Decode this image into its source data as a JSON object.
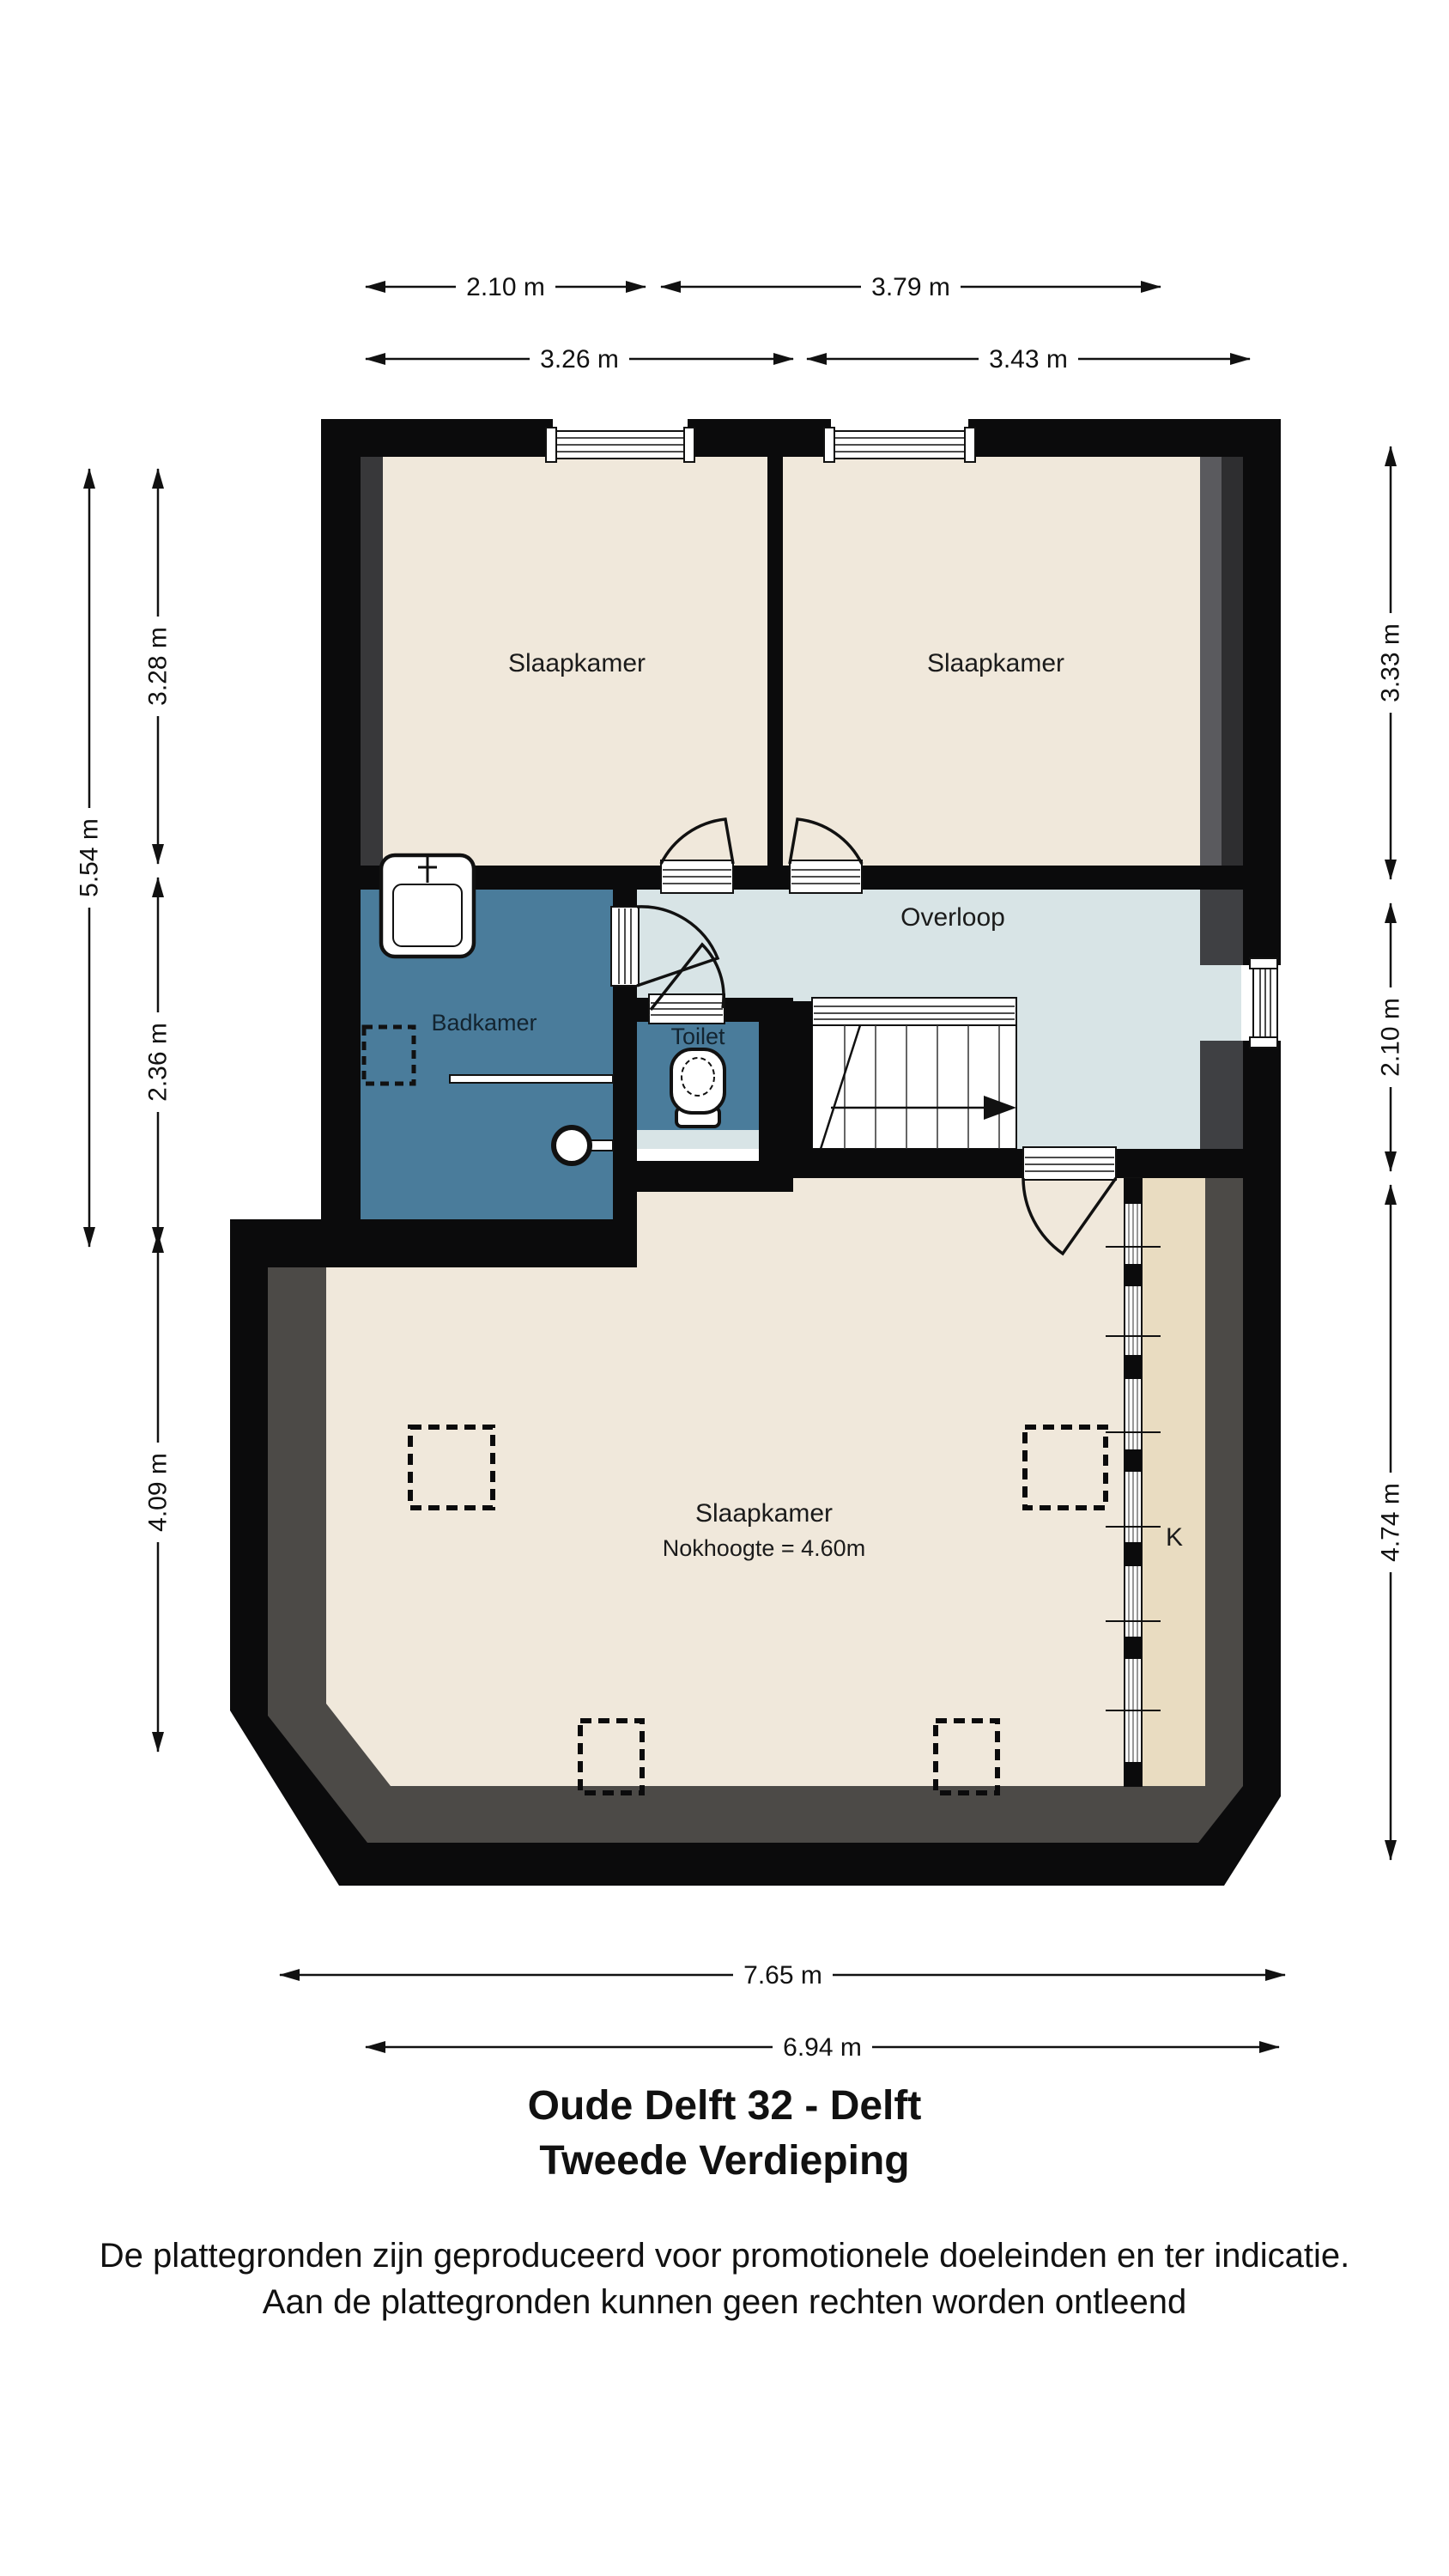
{
  "title": {
    "line1": "Oude Delft 32 - Delft",
    "line2": "Tweede Verdieping"
  },
  "disclaimer": {
    "line1": "De plattegronden zijn geproduceerd voor promotionele doeleinden en ter indicatie.",
    "line2": "Aan de plattegronden kunnen geen rechten worden ontleend"
  },
  "rooms": {
    "bedroom_top_left": {
      "label": "Slaapkamer"
    },
    "bedroom_top_right": {
      "label": "Slaapkamer"
    },
    "bathroom": {
      "label": "Badkamer"
    },
    "toilet": {
      "label": "Toilet"
    },
    "landing": {
      "label": "Overloop"
    },
    "bedroom_large": {
      "label": "Slaapkamer",
      "sublabel": "Nokhoogte = 4.60m"
    },
    "closet": {
      "label": "K"
    }
  },
  "dimensions": {
    "top_row1_left": "2.10 m",
    "top_row1_right": "3.79 m",
    "top_row2_left": "3.26 m",
    "top_row2_right": "3.43 m",
    "left_total": "5.54 m",
    "left_top": "3.28 m",
    "left_mid": "2.36 m",
    "left_bottom": "4.09 m",
    "right_top": "3.33 m",
    "right_mid": "2.10 m",
    "right_bottom": "4.74 m",
    "bottom_outer": "7.65 m",
    "bottom_inner": "6.94 m"
  },
  "colors": {
    "wall": "#0b0b0c",
    "bedroom_floor": "#f0e8db",
    "landing_floor": "#d8e4e6",
    "bathroom_floor": "#4a7c9b",
    "closet_floor": "#e9dcc1",
    "roof_slope_shade": "#4c4a47",
    "slope_shade_dark": "#2e2e30",
    "slope_shade_mid": "#5a5a5e",
    "dimension_text": "#111111"
  }
}
